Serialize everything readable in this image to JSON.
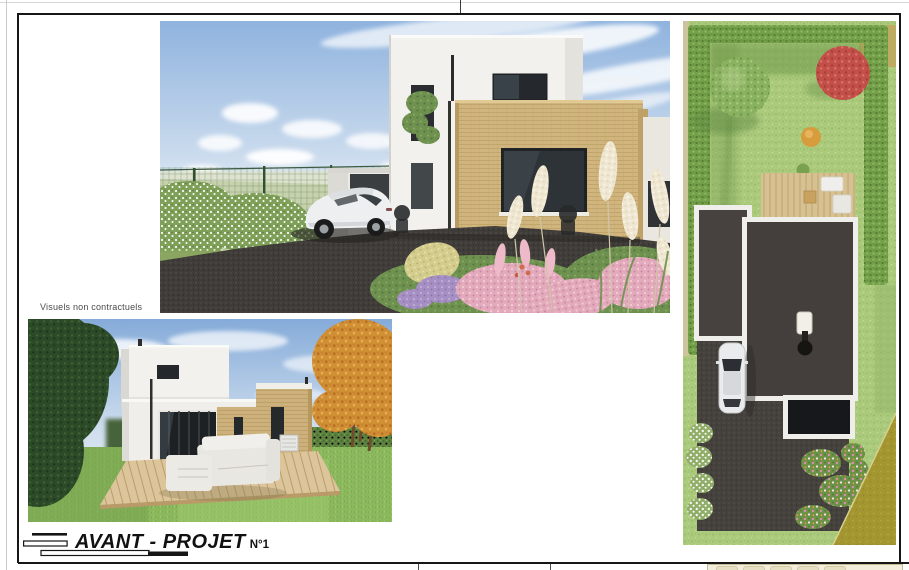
{
  "document": {
    "visuals_note": "Visuels non contractuels",
    "title": "AVANT - PROJET",
    "title_number": "N°1"
  },
  "renders": {
    "front_perspective": "street-side 3D render of modern flat-roof house with driveway and car",
    "back_perspective": "garden-side 3D render with wooden terrace and outdoor sofa",
    "aerial_plan": "top-down 3D site plan of the plot with garden, roofs, terrace and driveway"
  },
  "palette": {
    "sky_blue": "#8fb3de",
    "wall_white": "#f2f1ed",
    "wall_tan": "#d0b57e",
    "asphalt_gray": "#3f3c39",
    "lawn_green": "#a8c877",
    "roof_dark": "#443f3c",
    "deck_wood": "#d8c294",
    "red_tree": "#c25048",
    "road_olive": "#a89a33"
  }
}
